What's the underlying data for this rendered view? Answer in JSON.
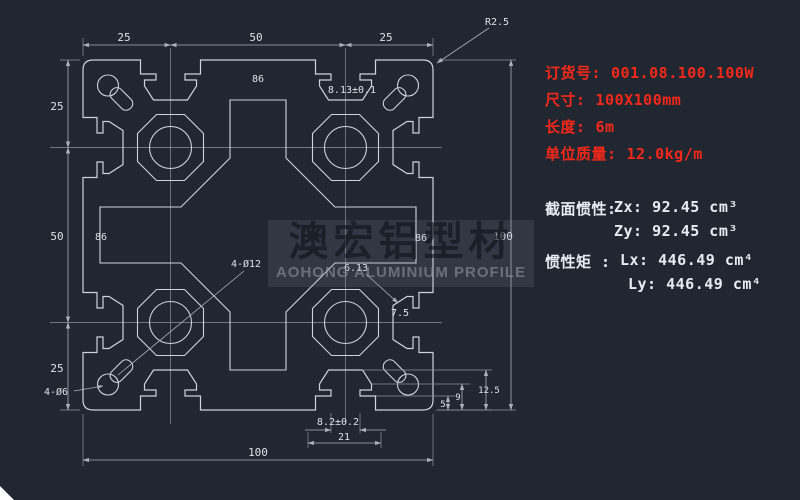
{
  "drawing": {
    "type": "aluminium-extrusion-profile-cross-section",
    "watermark": {
      "cn": "澳宏铝型材",
      "en": "AOHONG ALUMINIUM PROFILE"
    }
  },
  "specs_red": [
    {
      "label": "订货号:",
      "value": "001.08.100.100W"
    },
    {
      "label": "尺寸:",
      "value": "100X100mm"
    },
    {
      "label": "长度:",
      "value": "6m"
    },
    {
      "label": "单位质量:",
      "value": "12.0kg/m"
    }
  ],
  "inertia": {
    "section_label": "截面惯性:",
    "zx": "Zx: 92.45 cm³",
    "zy": "Zy: 92.45 cm³",
    "moment_label": "惯性矩 :",
    "lx": "Lx: 446.49 cm⁴",
    "ly": "Ly: 446.49 cm⁴"
  },
  "dims": {
    "top": [
      "25",
      "50",
      "25"
    ],
    "left": [
      "25",
      "50",
      "25"
    ],
    "overall_width": "100",
    "overall_height": "100",
    "inner_top": "86",
    "inner_left": "86",
    "inner_right": "86",
    "corner_radius": "R2.5",
    "slot_top_tol": "8.13±0.1",
    "slot_bottom_tol": "8.2±0.2",
    "slot_bottom_width": "21",
    "note_mid": "6.13",
    "holes_center": "4-Ø12",
    "holes_corner": "4-Ø6",
    "step_5": "5",
    "step_9": "9",
    "step_12_5": "12.5",
    "depth_7_5": "7.5"
  },
  "colors": {
    "background": "#212731",
    "line": "#cdd3db",
    "dim_text": "#dde1e8",
    "accent_red": "#f5281a"
  }
}
